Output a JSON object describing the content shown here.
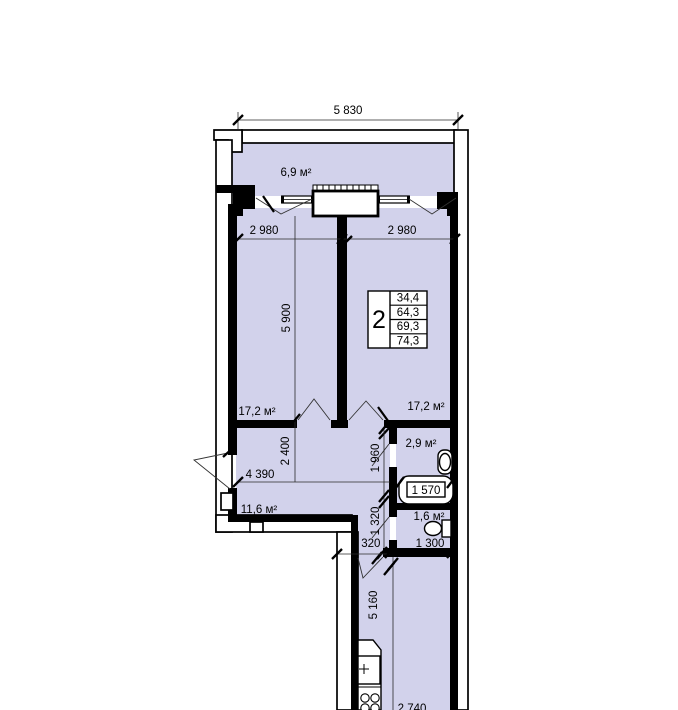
{
  "plan": {
    "colors": {
      "room_fill": "#d2d2eb",
      "wall": "#000000",
      "background": "#ffffff"
    },
    "unit_table": {
      "rooms": "2",
      "areas": [
        "34,4",
        "64,3",
        "69,3",
        "74,3"
      ]
    },
    "labels": {
      "balcony": "6,9 м²",
      "room_left": "17,2 м²",
      "room_right": "17,2 м²",
      "bathroom": "2,9 м²",
      "wc": "1,6 м²",
      "hall": "11,6 м²"
    },
    "dims": {
      "total_width": "5 830",
      "room_left_width": "2 980",
      "room_right_width": "2 980",
      "rooms_depth": "5 900",
      "hall_depth": "2 400",
      "hall_width": "4 390",
      "bath_depth": "1 960",
      "bathtub": "1 570",
      "lobby_depth": "1 320",
      "lobby_width": "1 320",
      "wc_width": "1 300",
      "kitchen_depth": "5 160",
      "kitchen_width": "2 740"
    }
  }
}
